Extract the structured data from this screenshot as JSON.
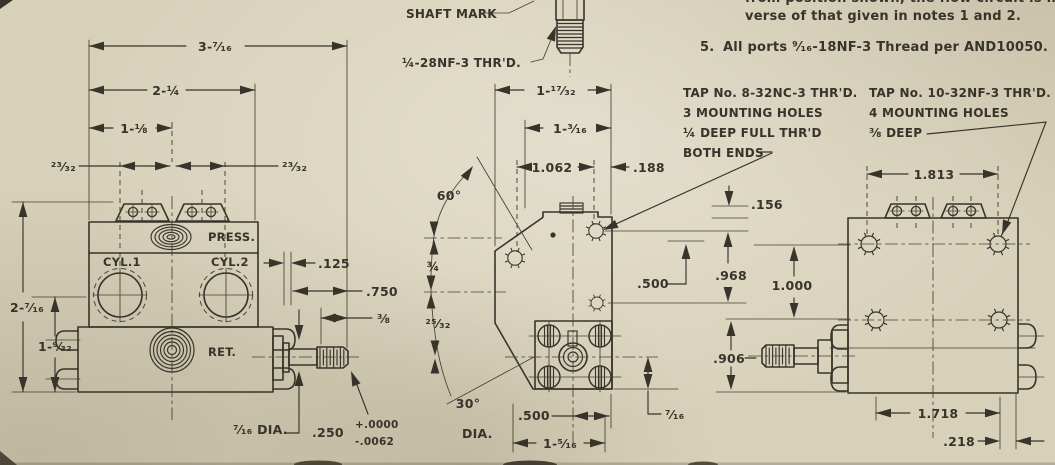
{
  "drawing": {
    "notes": {
      "line1_partial": "from position shown, the flow circuit is in the re-",
      "line2": "verse of that given in notes 1 and 2.",
      "note5_num": "5.",
      "note5": "All ports ⁹⁄₁₆-18NF-3 Thread per AND10050."
    },
    "callouts": {
      "shaft_mark": "SHAFT MARK",
      "shaft_thread": "¼-28NF-3 THR'D.",
      "tap_left": {
        "l1": "TAP No. 8-32NC-3 THR'D.",
        "l2": "3 MOUNTING HOLES",
        "l3": "¼ DEEP FULL THR'D",
        "l4": "BOTH ENDS"
      },
      "tap_right": {
        "l1": "TAP No. 10-32NF-3 THR'D.",
        "l2": "4 MOUNTING HOLES",
        "l3": "⅜ DEEP"
      }
    },
    "front_view": {
      "ports": {
        "press": "PRESS.",
        "cyl1": "CYL.1",
        "cyl2": "CYL.2",
        "ret": "RET."
      },
      "dims": {
        "width_total": "3-⁷⁄₁₆",
        "width_body": "2-¼",
        "width_center": "1-⅛",
        "bracket_left": "²³⁄₃₂",
        "bracket_right": "²³⁄₃₂",
        "height_total": "2-⁷⁄₁₆",
        "height_lower": "1-⁹⁄₃₂",
        "boss_dia": "⁷⁄₁₆ DIA.",
        "plate": ".125",
        "shaft_len": ".750",
        "thread_len": "⅜",
        "shaft_dia": ".250",
        "tol_plus": "+.0000",
        "tol_minus": "-.0062",
        "dia_label": "DIA."
      }
    },
    "side_view": {
      "dims": {
        "w1": "1-¹⁷⁄₃₂",
        "w2": "1-³⁄₁₆",
        "w3": "1.062",
        "w4": ".188",
        "angle_top": "60°",
        "h1": "¾",
        "h2": "²⁵⁄₃₂",
        "angle_bottom": "30°",
        "right_offset": ".500",
        "bottom_offset": ".500",
        "bottom_width": "1-⁵⁄₁₆",
        "side_offset": "⁷⁄₁₆"
      }
    },
    "rear_view": {
      "dims": {
        "hole_span_top": "1.813",
        "lip": ".156",
        "h1": ".968",
        "h2": "1.000",
        "h3": ".906",
        "hole_span_bottom": "1.718",
        "edge_offset": ".218"
      }
    },
    "colors": {
      "paper": "#d8d1ba",
      "ink": "#37342b"
    }
  }
}
